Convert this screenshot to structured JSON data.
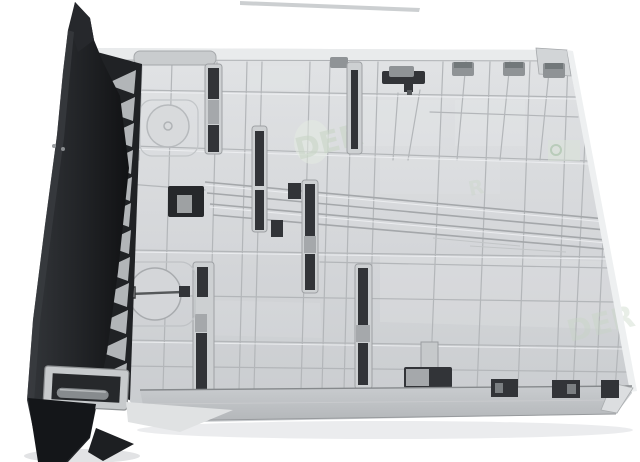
{
  "scene": {
    "subject": "Printer paper tray cassette photographed from its rear underside, tilted, on a plain white background",
    "view": "black front bezel edge-on at the left with serrated ribs; large light-gray molded plastic underside with grid ribs, guide slots, two round adjuster dials, slide rails and dark latch slots; gray retaining clips along the top edge; darker gray bottom edge band",
    "background_color": "#ffffff"
  },
  "colors": {
    "tray_base": "#d5d7da",
    "tray_light": "#e9ebec",
    "tray_band": "#bdc0c3",
    "rib_line": "#b3b6b9",
    "bezel_black": "#1c1e21",
    "slot_dark": "#323438",
    "clip_gray": "#8f9396",
    "tooth_gray": "#b2b5b8",
    "watermark_green": "#c6d4c4"
  },
  "watermark": {
    "fragments": [
      {
        "text": "DER"
      },
      {
        "text": "DER"
      },
      {
        "text": "R"
      }
    ]
  }
}
